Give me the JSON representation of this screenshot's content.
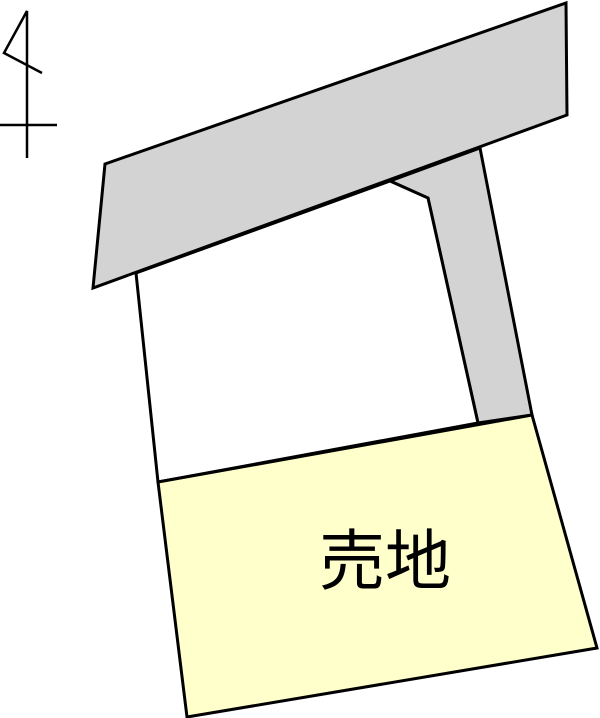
{
  "diagram": {
    "title": "land-parcel-plan",
    "background_color": "#ffffff",
    "outline_color": "#000000",
    "outline_width": 3,
    "colors": {
      "road_fill": "#d3d3d3",
      "adjacent_lot_fill": "#ffffff",
      "sale_lot_fill": "#ffffcc"
    },
    "label": {
      "text": "売地",
      "color": "#000000",
      "x": 385,
      "y": 561,
      "font_size": 66
    },
    "shapes": [
      {
        "name": "upper-road",
        "fill_key": "road_fill",
        "points": "105,164 566,3 567,115 93,288"
      },
      {
        "name": "branch-road",
        "fill_key": "road_fill",
        "points": "390,181 480,148 532,415 478,423 428,198"
      },
      {
        "name": "adjacent-lot",
        "fill_key": "adjacent_lot_fill",
        "points": "136,273 390,181 428,198 478,423 158,482"
      },
      {
        "name": "sale-lot",
        "fill_key": "sale_lot_fill",
        "points": "158,482 532,415 597,648 187,717"
      }
    ],
    "north_arrow": {
      "stroke_width": 2.5,
      "polylines": [
        "27,158 27,11 4,53 42,73",
        "0,125 57,125"
      ]
    }
  }
}
